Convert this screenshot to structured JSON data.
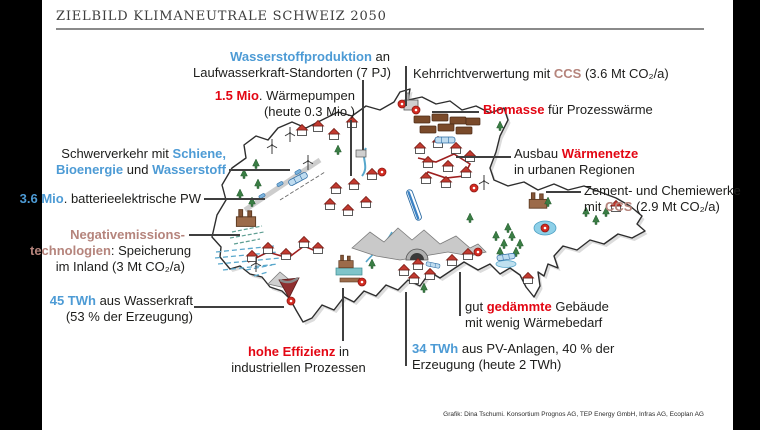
{
  "frame": {
    "title": "ZIELBILD KLIMANEUTRALE SCHWEIZ 2050",
    "credit": "Grafik: Dina Tschumi. Konsortium Prognos AG, TEP Energy GmbH, Infras AG, Ecoplan AG"
  },
  "colors": {
    "accent_blue": "#4D9BD5",
    "accent_red": "#E30613",
    "accent_ccs": "#B5847C",
    "ink": "#1D1D1B",
    "frame_bars": "#000000"
  },
  "labels": {
    "hydrogen": {
      "l1a": "Wasserstoffproduktion",
      "l1b": " an",
      "l2": "Laufwasserkraft-Standorten (7 PJ)"
    },
    "heatpumps": {
      "l1a": "1.5 Mio",
      "l1b": ". Wärmepumpen",
      "l2": "(heute 0.3 Mio.)"
    },
    "waste": {
      "a": "Kehrrichtverwertung mit ",
      "b": "CCS",
      "c": " (3.6 Mt CO₂/a)"
    },
    "biomass": {
      "a": "Biomasse",
      "b": " für Prozesswärme"
    },
    "transport": {
      "l1a": "Schwerverkehr mit ",
      "l1b": "Schiene,",
      "l2a": "Bioenergie",
      "l2b": " und ",
      "l2c": "Wasserstoff"
    },
    "bev": {
      "a": "3.6 Mio",
      "b": ". batterieelektrische PW"
    },
    "negem": {
      "l1": "Negativemissions-",
      "l2a": "technologien",
      "l2b": ": Speicherung",
      "l3": "im Inland (3 Mt CO₂/a)"
    },
    "hydro": {
      "l1a": "45 TWh",
      "l1b": " aus Wasserkraft",
      "l2": "(53 % der Erzeugung)"
    },
    "efficiency": {
      "l1a": "hohe Effizienz",
      "l1b": " in",
      "l2": "industriellen Prozessen"
    },
    "pv": {
      "l1a": "34 TWh",
      "l1b": " aus PV-Anlagen, 40 % der",
      "l2": "Erzeugung (heute 2 TWh)"
    },
    "insulation": {
      "l1a": "gut ",
      "l1b": "gedämmte",
      "l1c": " Gebäude",
      "l2": "mit wenig Wärmebedarf"
    },
    "heatnets": {
      "l1a": "Ausbau ",
      "l1b": "Wärmenetze",
      "l2": "in urbanen Regionen"
    },
    "cement": {
      "l1": "Zement- und Chemiewerke",
      "l2a": "mit ",
      "l2b": "CCS",
      "l2c": " (2.9 Mt CO₂/a)"
    }
  },
  "map": {
    "country": "Schweiz",
    "style": "hand-drawn illustrated map",
    "icons": [
      "wind-turbine",
      "house",
      "pine-tree",
      "train",
      "high-speed-train",
      "factory",
      "biomass-panels",
      "waste-plant",
      "mountain-range",
      "lake",
      "dam-reservoir",
      "tunnel",
      "district-heating-network",
      "heat-pump-marker",
      "car",
      "hatched-water",
      "road",
      "river"
    ]
  }
}
